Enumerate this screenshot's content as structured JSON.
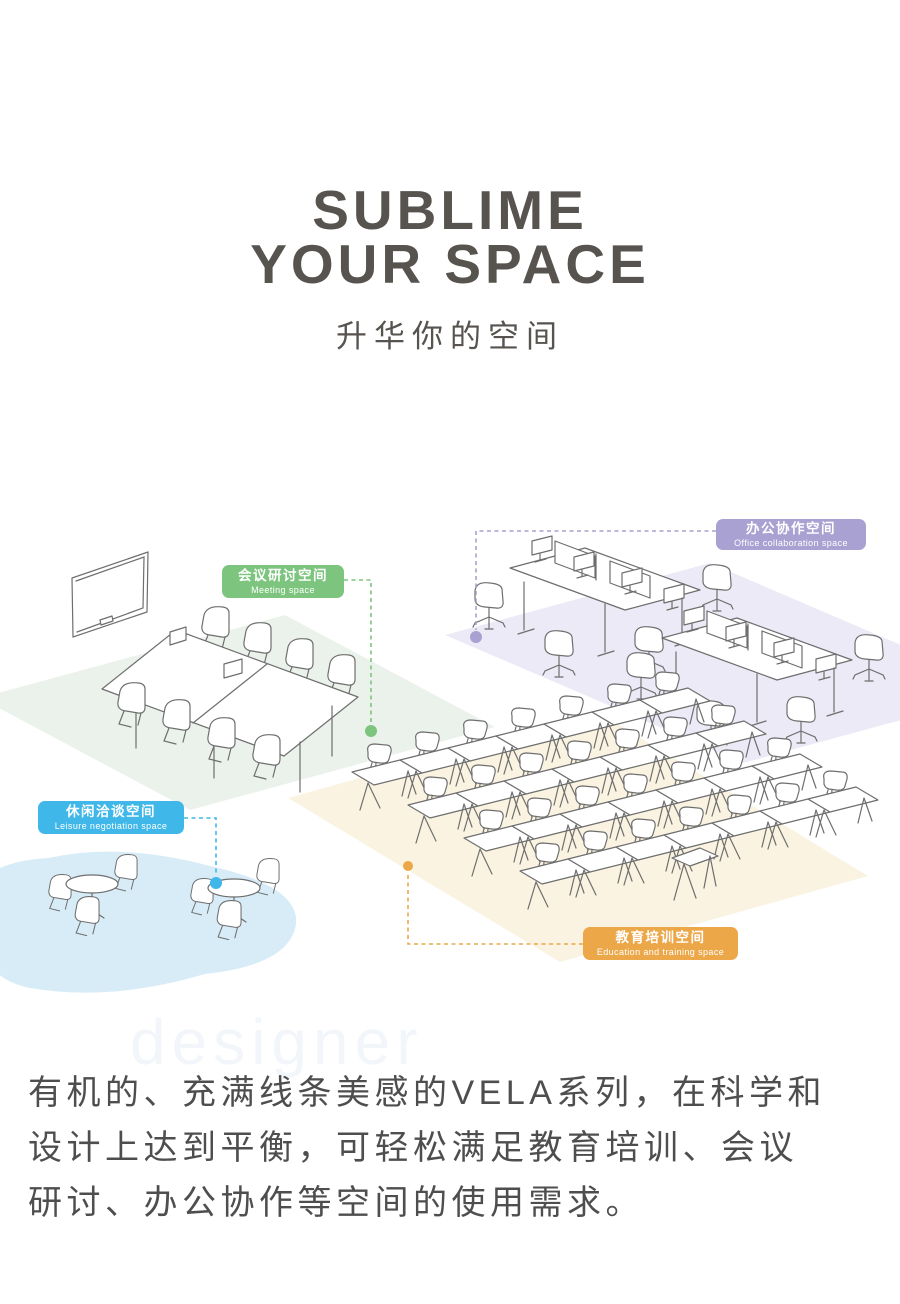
{
  "header": {
    "title_line1": "SUBLIME",
    "title_line2": "YOUR SPACE",
    "subtitle": "升华你的空间"
  },
  "illustration": {
    "watermark": "designer",
    "line_color": "#6e6e6e",
    "zones": [
      {
        "id": "meeting",
        "label_cn": "会议研讨空间",
        "label_en": "Meeting space",
        "color": "#7dc57f",
        "floor_color": "#ebf2ec"
      },
      {
        "id": "office",
        "label_cn": "办公协作空间",
        "label_en": "Office collaboration space",
        "color": "#a8a1d2",
        "floor_color": "#ebeaf6"
      },
      {
        "id": "leisure",
        "label_cn": "休闲洽谈空间",
        "label_en": "Leisure negotiation space",
        "color": "#3fb7e9",
        "floor_color": "#d8ecf8"
      },
      {
        "id": "training",
        "label_cn": "教育培训空间",
        "label_en": "Education and training space",
        "color": "#eca749",
        "floor_color": "#faf3e1"
      }
    ]
  },
  "description": {
    "text": "有机的、充满线条美感的VELA系列，在科学和\n设计上达到平衡，可轻松满足教育培训、会议\n研讨、办公协作等空间的使用需求。"
  }
}
